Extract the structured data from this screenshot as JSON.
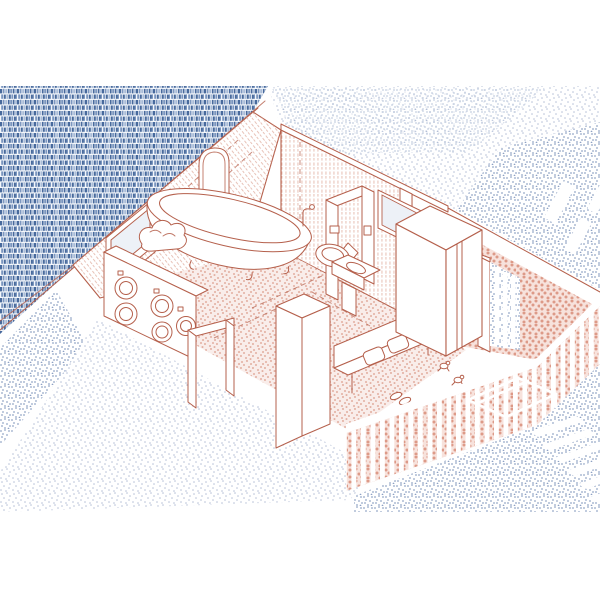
{
  "illustration": {
    "type": "axonometric-cutaway-interior",
    "room": "attic-bathroom-laundry-with-terrace-stair",
    "style": "hand-drawn red line work with blue knit and stipple textures"
  },
  "palette": {
    "red": "#b5604c",
    "redLight": "#dfab9c",
    "glass": "#edf1f7",
    "paper": "#ffffff",
    "pinkBg": "#f9edea",
    "pinkDot": "#e3b2a4",
    "pinkDenseBg": "#f7e2dc",
    "pinkDenseDot": "#dd9a88",
    "knitDark": "#47699c",
    "knitMid": "#7b96bf",
    "knitLight": "#a9bcd8",
    "stipLight": "#b3bdd6",
    "stipMed": "#8ea1c4"
  },
  "scene": {
    "objects": [
      "knitted-brick-roof",
      "sloped-attic-wall",
      "rear-wall",
      "arched-niche",
      "slope-window",
      "clawfoot-bathtub",
      "wall-hung-toilet",
      "pedestal-sink",
      "mirror-panel",
      "partition-doorframe",
      "washing-machines",
      "laundry-basket",
      "open-doorframe",
      "cut-wall-pillar",
      "bench-with-towels",
      "aloe-plant-pot",
      "frogs",
      "slippers",
      "wardrobe",
      "terrace-doorway",
      "shutter-slats",
      "terrace-railing",
      "stairwell-with-steps",
      "courtyard-ground"
    ]
  }
}
